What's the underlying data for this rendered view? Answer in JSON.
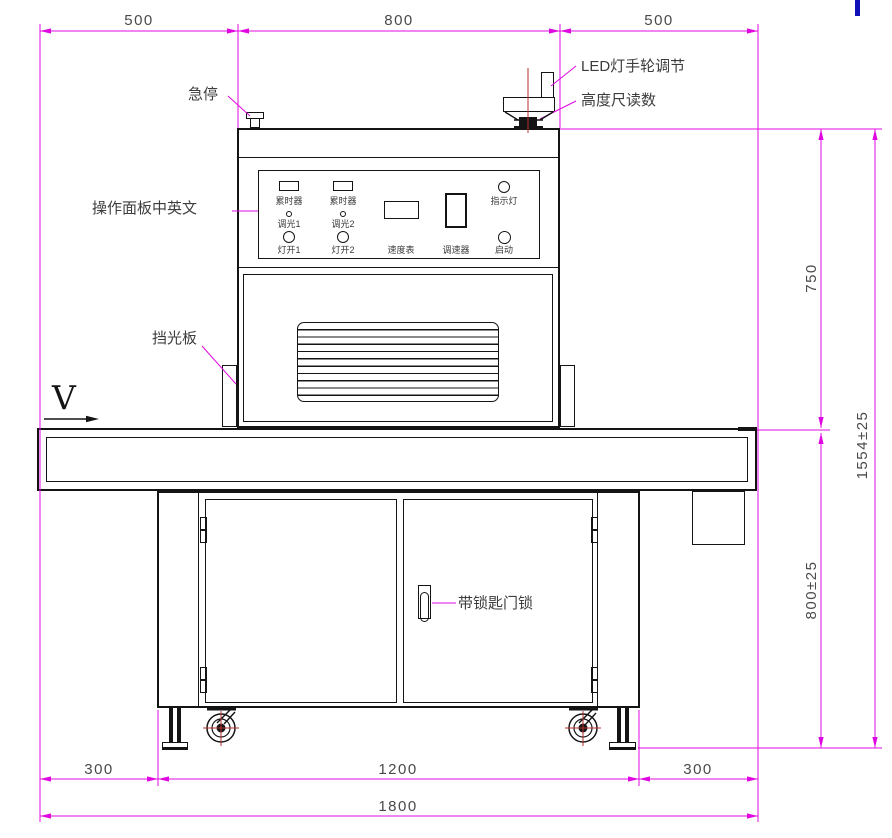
{
  "drawing_title": "LED curing conveyor machine front view",
  "direction_label": "V",
  "annotations": {
    "estop": "急停",
    "led_handwheel": "LED灯手轮调节",
    "height_scale": "高度尺读数",
    "control_panel": "操作面板中英文",
    "light_shield": "挡光板",
    "door_lock": "带锁匙门锁"
  },
  "control_panel": {
    "timer1": "累时器",
    "timer2": "累时器",
    "dimmer1": "调光1",
    "dimmer2": "调光2",
    "lamp_on1": "灯开1",
    "lamp_on2": "灯开2",
    "speed_meter": "速度表",
    "speed_controller": "调速器",
    "indicator_lamp": "指示灯",
    "start": "启动"
  },
  "dimensions": {
    "top_left": "500",
    "top_middle": "800",
    "top_right": "500",
    "right_upper": "750",
    "right_overall": "1554±25",
    "right_lower": "800±25",
    "bottom_left": "300",
    "bottom_middle": "1200",
    "bottom_right": "300",
    "bottom_overall": "1800"
  },
  "colors": {
    "dimension_magenta": "#e008e0",
    "drawing_line": "#141414",
    "centerline_red": "#b03030",
    "corner_mark_blue": "#1010b8",
    "dim_text": "#4a4a4a"
  }
}
